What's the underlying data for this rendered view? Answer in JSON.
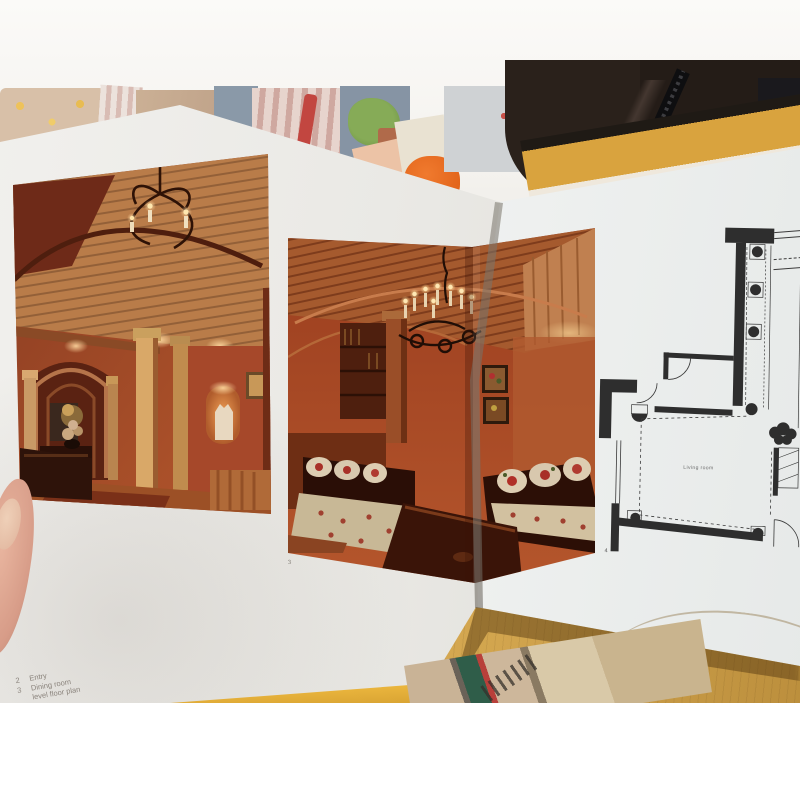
{
  "book": {
    "captions": {
      "line1": {
        "num": "2",
        "label": "Entry"
      },
      "line2": {
        "num": "3",
        "label": "Dining room"
      },
      "line3": {
        "num": "",
        "label": "level floor plan"
      }
    },
    "photo2_page_mark": "3",
    "floor_plan": {
      "room_label": "Living room",
      "page_mark": "4"
    }
  },
  "colors": {
    "page_white": "#eceeec",
    "table_wood": "#d2a54e",
    "photo_warm_wall": "#a6482a",
    "photo_ceiling_wood": "#b97c49",
    "plan_line": "#3a3a3a",
    "coat_dark": "#2a211b",
    "book_edge_yellow": "#d9a33e"
  }
}
